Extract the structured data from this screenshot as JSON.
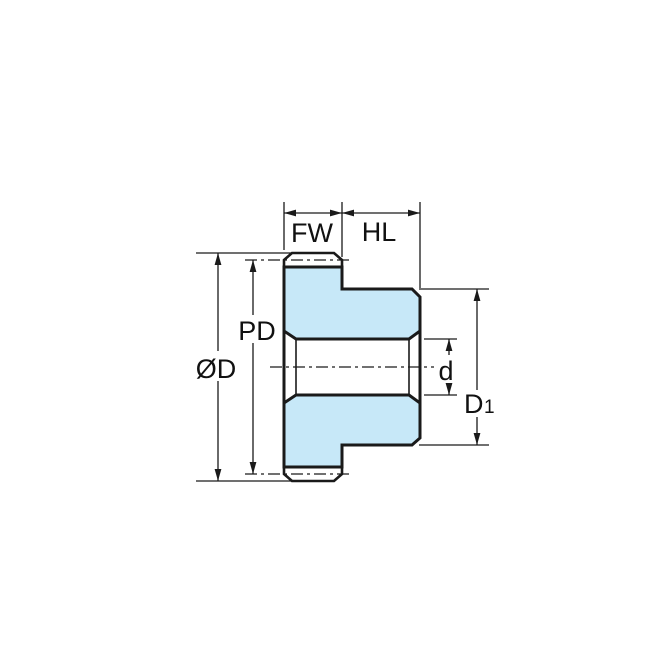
{
  "diagram": {
    "labels": {
      "face_width": "FW",
      "hub_length": "HL",
      "outside_diameter": "ØD",
      "pitch_diameter": "PD",
      "bore_diameter": "d",
      "hub_diameter_letter": "D",
      "hub_diameter_subscript": "1"
    },
    "colors": {
      "part_fill": "#c7e8f8",
      "line": "#1a1a1a",
      "background": "#ffffff"
    }
  }
}
